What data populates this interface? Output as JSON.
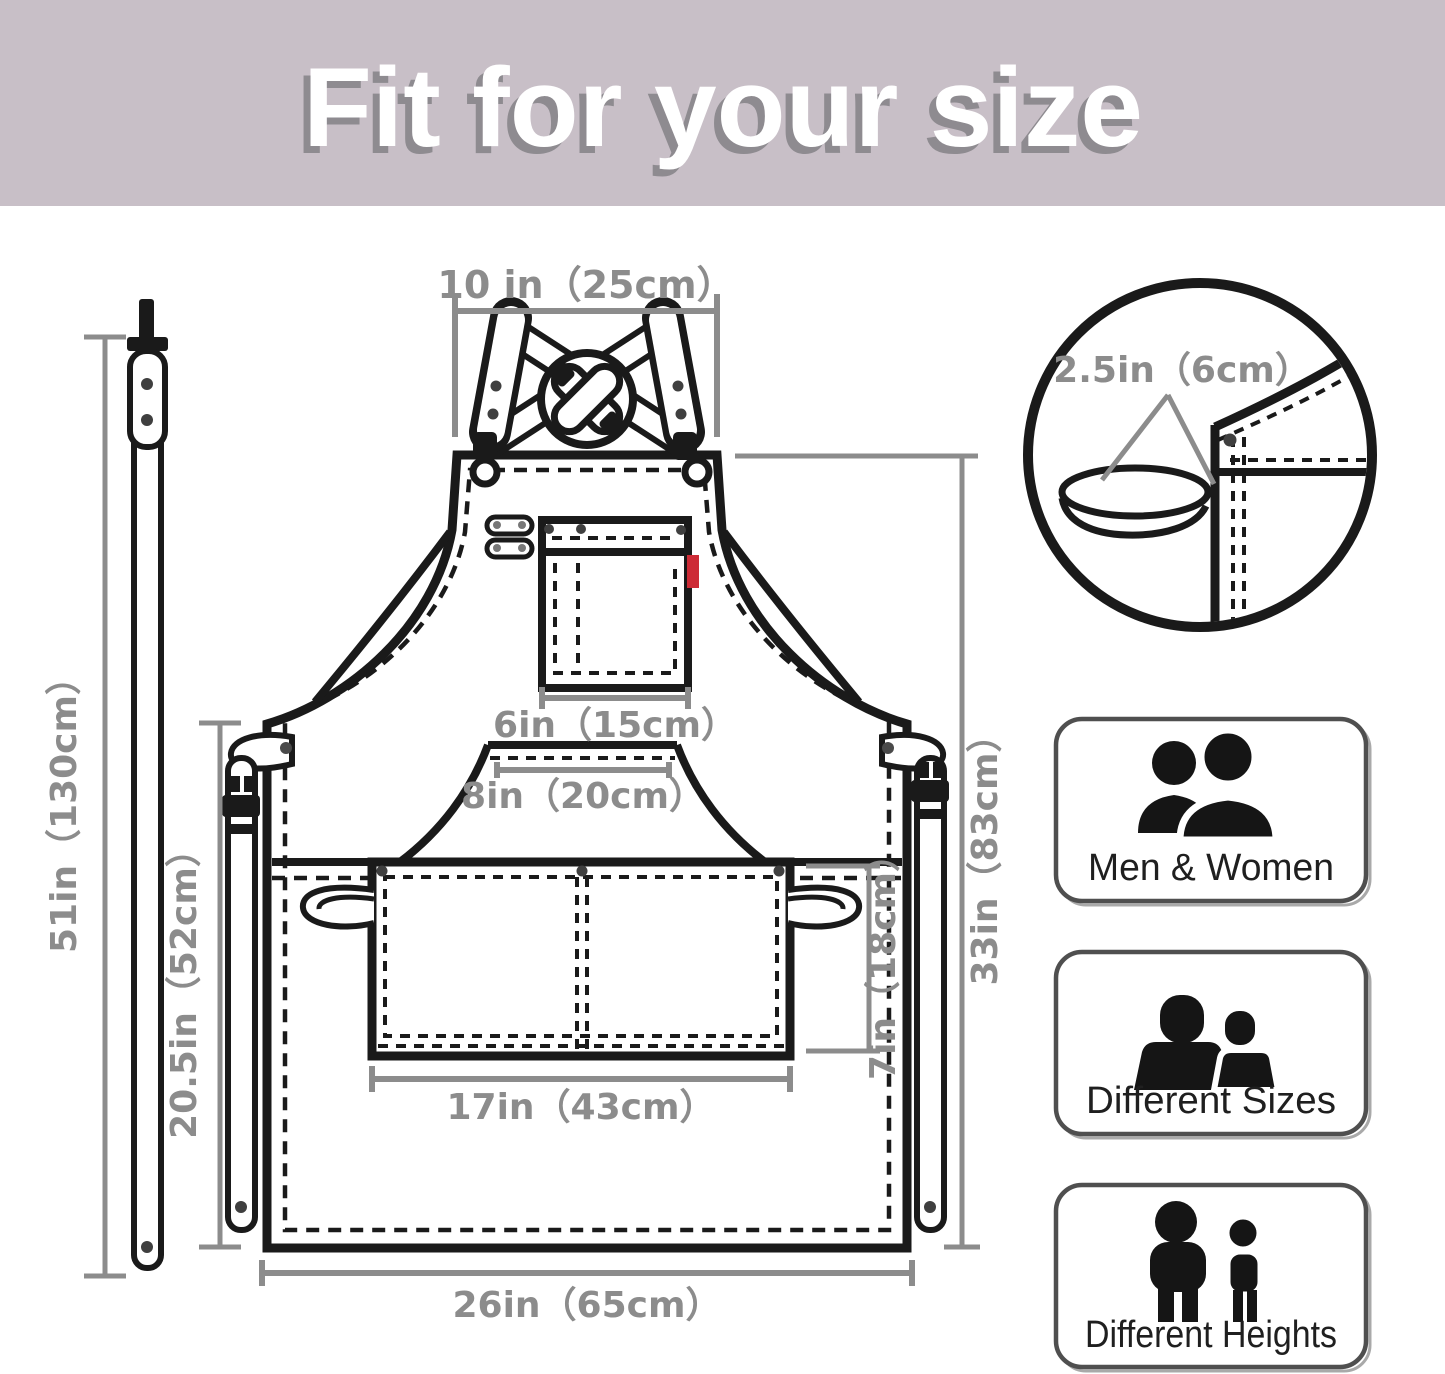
{
  "header": {
    "title": "Fit for your size"
  },
  "colors": {
    "header_bg": "#c8bfc7",
    "title_shadow": "#8e8b90",
    "dimension_gray": "#8c8c8c",
    "ink": "#1a1a1a",
    "tag_red": "#cd2b36"
  },
  "dimensions": {
    "neck_strap_length": "51in（130cm）",
    "top_strap_width": "10 in（25cm）",
    "chest_pocket_width": "6in（15cm）",
    "pouch_opening_width": "8in（20cm）",
    "front_pocket_width": "17in（43cm）",
    "bottom_width": "26in（65cm）",
    "side_length": "20.5in（52cm）",
    "total_length": "33in（83cm）",
    "pocket_height": "7in（18cm）",
    "strap_loop_width": "2.5in（6cm）"
  },
  "badges": [
    {
      "label": "Men & Women"
    },
    {
      "label": "Different Sizes"
    },
    {
      "label": "Different Heights"
    }
  ]
}
